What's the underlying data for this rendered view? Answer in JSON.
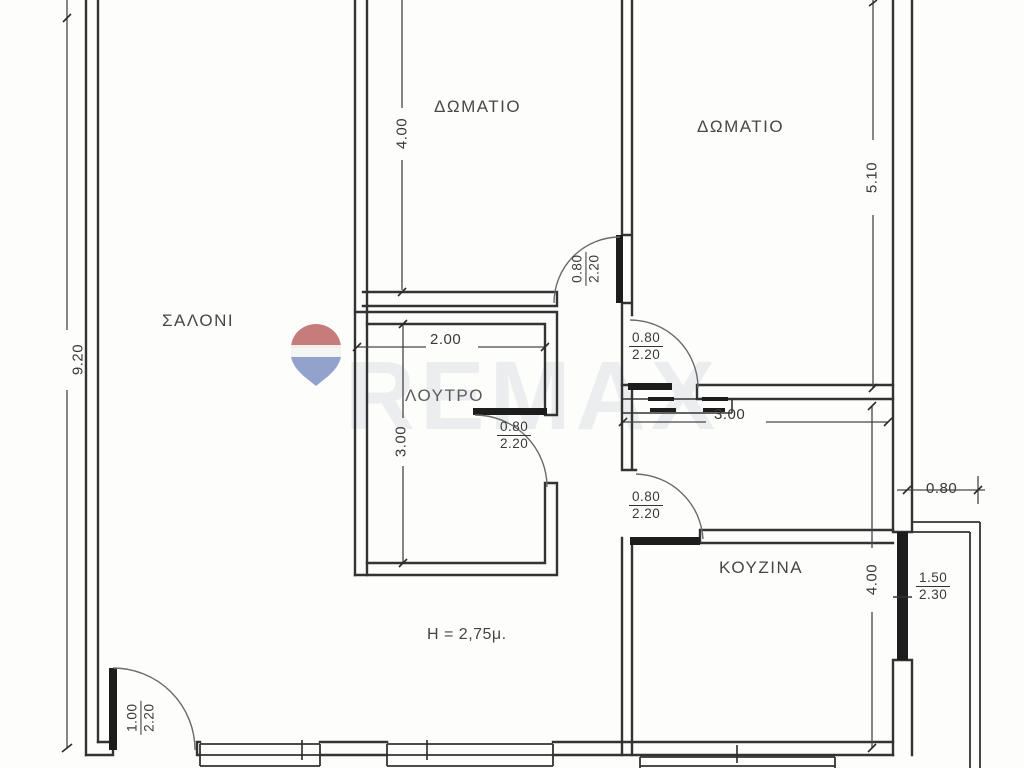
{
  "plan": {
    "rooms": {
      "salon": "ΣΑΛΟΝΙ",
      "bedroom1": "ΔΩΜΑΤΙΟ",
      "bedroom2": "ΔΩΜΑΤΙΟ",
      "bathroom": "ΛΟΥΤΡΟ",
      "kitchen": "ΚΟΥΖΙΝΑ"
    },
    "ceiling_height_note": "H = 2,75μ.",
    "dims": {
      "salon_depth": "9.20",
      "bedroom1_depth": "4.00",
      "bedroom2_depth": "5.10",
      "bathroom_width": "2.00",
      "bathroom_depth": "3.00",
      "hall_width": "3.00",
      "kitchen_depth": "4.00",
      "balcony_width": "0.80",
      "top_width_1": "3.10",
      "top_width_2": "3.30",
      "top_width_3": "3.30"
    },
    "openings": {
      "bedroom1_door_w": "0.80",
      "bedroom1_door_h": "2.20",
      "bedroom2_door_w": "0.80",
      "bedroom2_door_h": "2.20",
      "bathroom_door_w": "0.80",
      "bathroom_door_h": "2.20",
      "kitchen_door_w": "0.80",
      "kitchen_door_h": "2.20",
      "entrance_door_w": "1.00",
      "entrance_door_h": "2.20",
      "balcony_window_w": "1.50",
      "balcony_window_h": "2.30"
    },
    "watermark": {
      "brand": "REMAX",
      "balloon_red": "#bf6a6a",
      "balloon_white": "#f4f4f2",
      "balloon_blue": "#8495c5",
      "text_gray": "#9aa0ae"
    }
  }
}
